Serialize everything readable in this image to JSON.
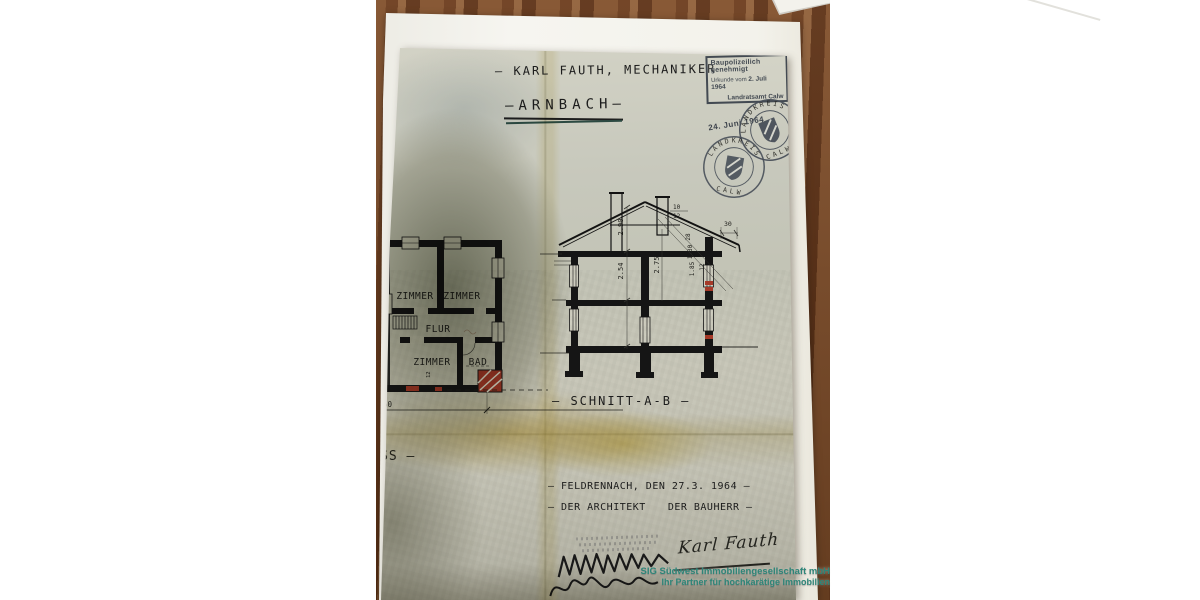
{
  "document": {
    "title": "— KARL FAUTH, MECHANIKER",
    "location": "—ARNBACH—",
    "approval_stamp": {
      "line1": "Baupolizeilich genehmigt",
      "line2_label": "Urkunde vom",
      "line2_date": "2. Juli 1964",
      "line3": "Landratsamt Calw"
    },
    "date_stamp": "24. Juni 1964",
    "seal": {
      "top": "LANDKREIS",
      "bottom": "CALW"
    },
    "floor_plan": {
      "room_top_left": "ZIMMER",
      "room_top_right": "ZIMMER",
      "hall": "FLUR",
      "room_bottom": "ZIMMER",
      "bath": "BAD",
      "dim_60": "60",
      "dim_12": "12"
    },
    "section": {
      "label": "— SCHNITT-A-B —",
      "dim_290": "2.90",
      "dim_254": "2.54",
      "dim_275": "2.75",
      "dim_185": "1.85",
      "dim_130": "1.30",
      "dim_28": "28",
      "dim_12": "12",
      "dim_10": "10",
      "dim_12b": "12",
      "dim_30": "30"
    },
    "left_fragment": "SS —",
    "footer": {
      "place_date": "— FELDRENNACH, DEN 27.3. 1964 —",
      "architect": "— DER ARCHITEKT",
      "builder": "DER BAUHERR —",
      "signature": "Karl Fauth"
    }
  },
  "watermark": {
    "line1": "SIG Südwest Immobiliengesellschaft mbH",
    "line2": "Ihr Partner für hochkarätige Immobilien"
  },
  "colors": {
    "watermark_teal": "#2e8578",
    "ink": "#1c1c1c",
    "stamp_blue": "#434a52",
    "accent_red": "#a93a28"
  }
}
